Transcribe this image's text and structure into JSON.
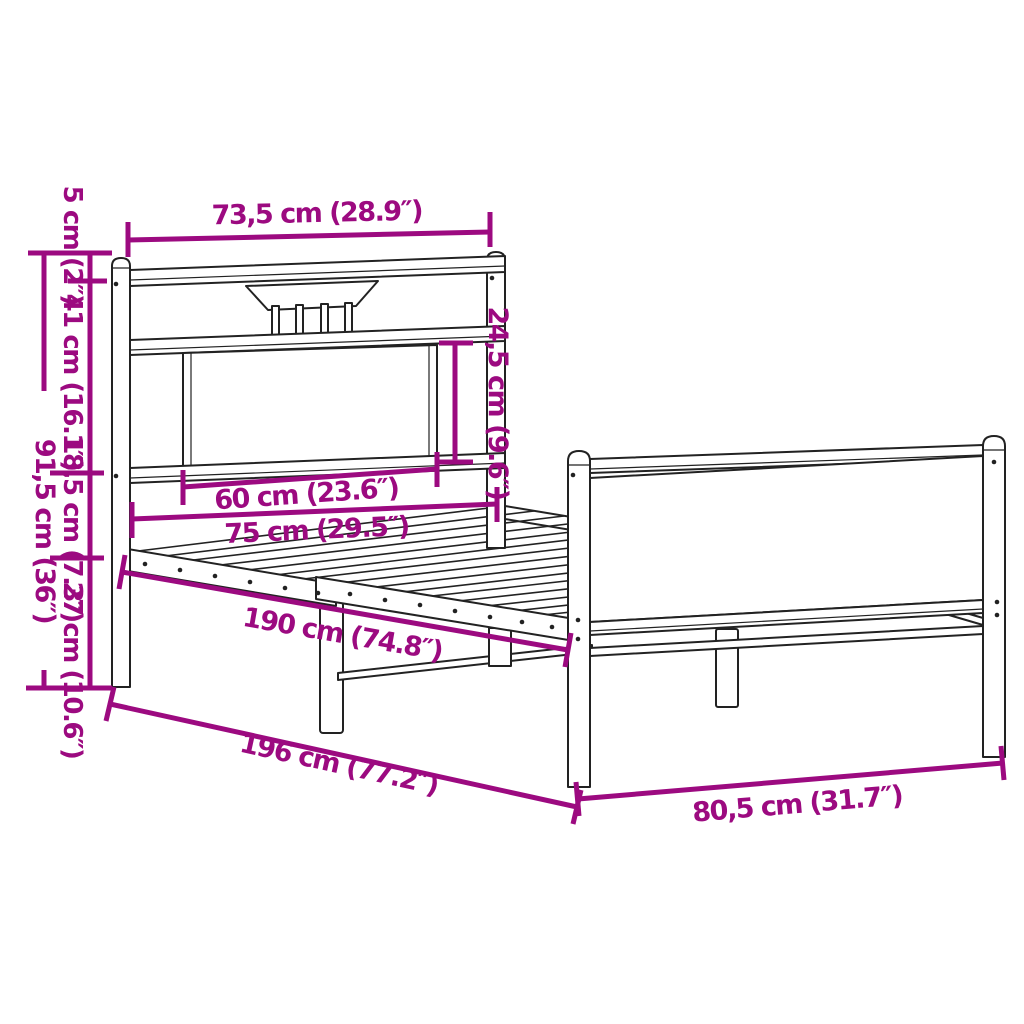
{
  "image_type": "product-dimension-diagram",
  "subject": "metal bed frame with headboard and footboard, slatted base",
  "colors": {
    "dimension_annotation": "#9C0A80",
    "drawing_outline": "#222222",
    "background": "#ffffff"
  },
  "dims": {
    "headboard_width": "73,5 cm (28.9″)",
    "post_cap_height": "5 cm (2″)",
    "headboard_upper_height": "41 cm (16.1″)",
    "rail_section_height": "18,5 cm (7.3″)",
    "underbed_clearance": "27 cm (10.6″)",
    "total_height": "91,5 cm (36″)",
    "headboard_panel_height": "24,5 cm (9.6″)",
    "headboard_panel_width": "60 cm (23.6″)",
    "mattress_width": "75 cm (29.5″)",
    "mattress_length": "190 cm (74.8″)",
    "total_length": "196 cm (77.2″)",
    "footboard_width": "80,5 cm (31.7″)"
  }
}
